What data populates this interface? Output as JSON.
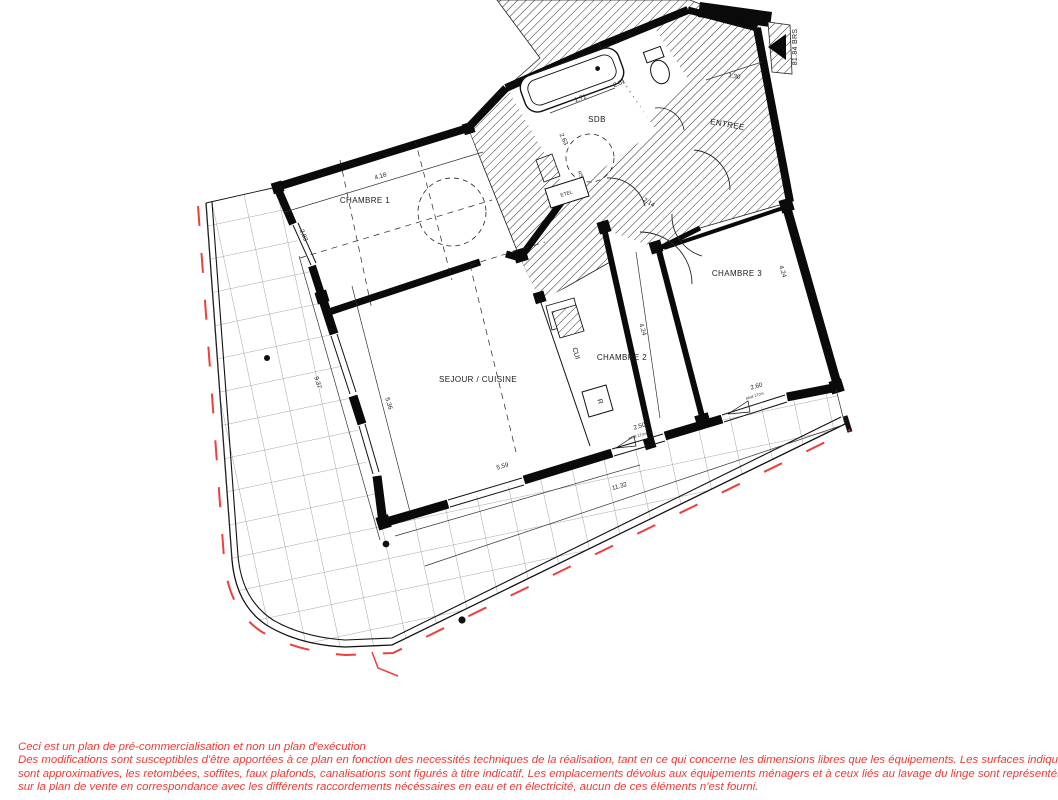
{
  "rooms": {
    "chambre1": "CHAMBRE 1",
    "chambre2": "CHAMBRE 2",
    "chambre3": "CHAMBRE 3",
    "sejour_cuisine": "SEJOUR / CUISINE",
    "sdb": "SDB",
    "entree": "ENTREE"
  },
  "kitchen": {
    "cui": "CUI",
    "fridge": "R",
    "duct": "ETEL",
    "rs": "RS"
  },
  "dimensions": {
    "ch1_width": "4.18",
    "ch1_depth": "2.83",
    "bath_width": "1.71",
    "sdb_diag": "2.01",
    "sdb_depth": "2.63",
    "entree_width": "1.30",
    "hall": "2.14",
    "ch2_depth": "4.24",
    "ch3_depth": "4.24",
    "ch2_window": "2.50",
    "ch3_window": "2.60",
    "sejour_width": "5.59",
    "facade_total": "11.32",
    "left_total": "9.37",
    "sejour_left": "5.36",
    "sill_ch2": "seuil 17cm",
    "sill_ch3": "seuil 17cm"
  },
  "marker": {
    "elevation": "81.84 BRS"
  },
  "disclaimer": {
    "color": "#ee3a34",
    "lines": [
      "Ceci est un plan de pré-commercialisation et non un plan d'exécution",
      "Des modifications sont susceptibles d'être apportées à ce plan en fonction des necessités techniques de la réalisation, tant en ce qui concerne les dimensions libres que les équipements. Les surfaces indiquées",
      "sont approximatives, les retombées, soffites, faux plafonds, canalisations sont figurés à titre indicatif. Les emplacements dévolus aux équipements ménagers et à ceux liés au lavage du linge sont représentés",
      "sur la plan de vente en correspondance avec les différents raccordements nécéssaires en eau et en électricité, aucun de ces éléments n'est fourni."
    ]
  }
}
